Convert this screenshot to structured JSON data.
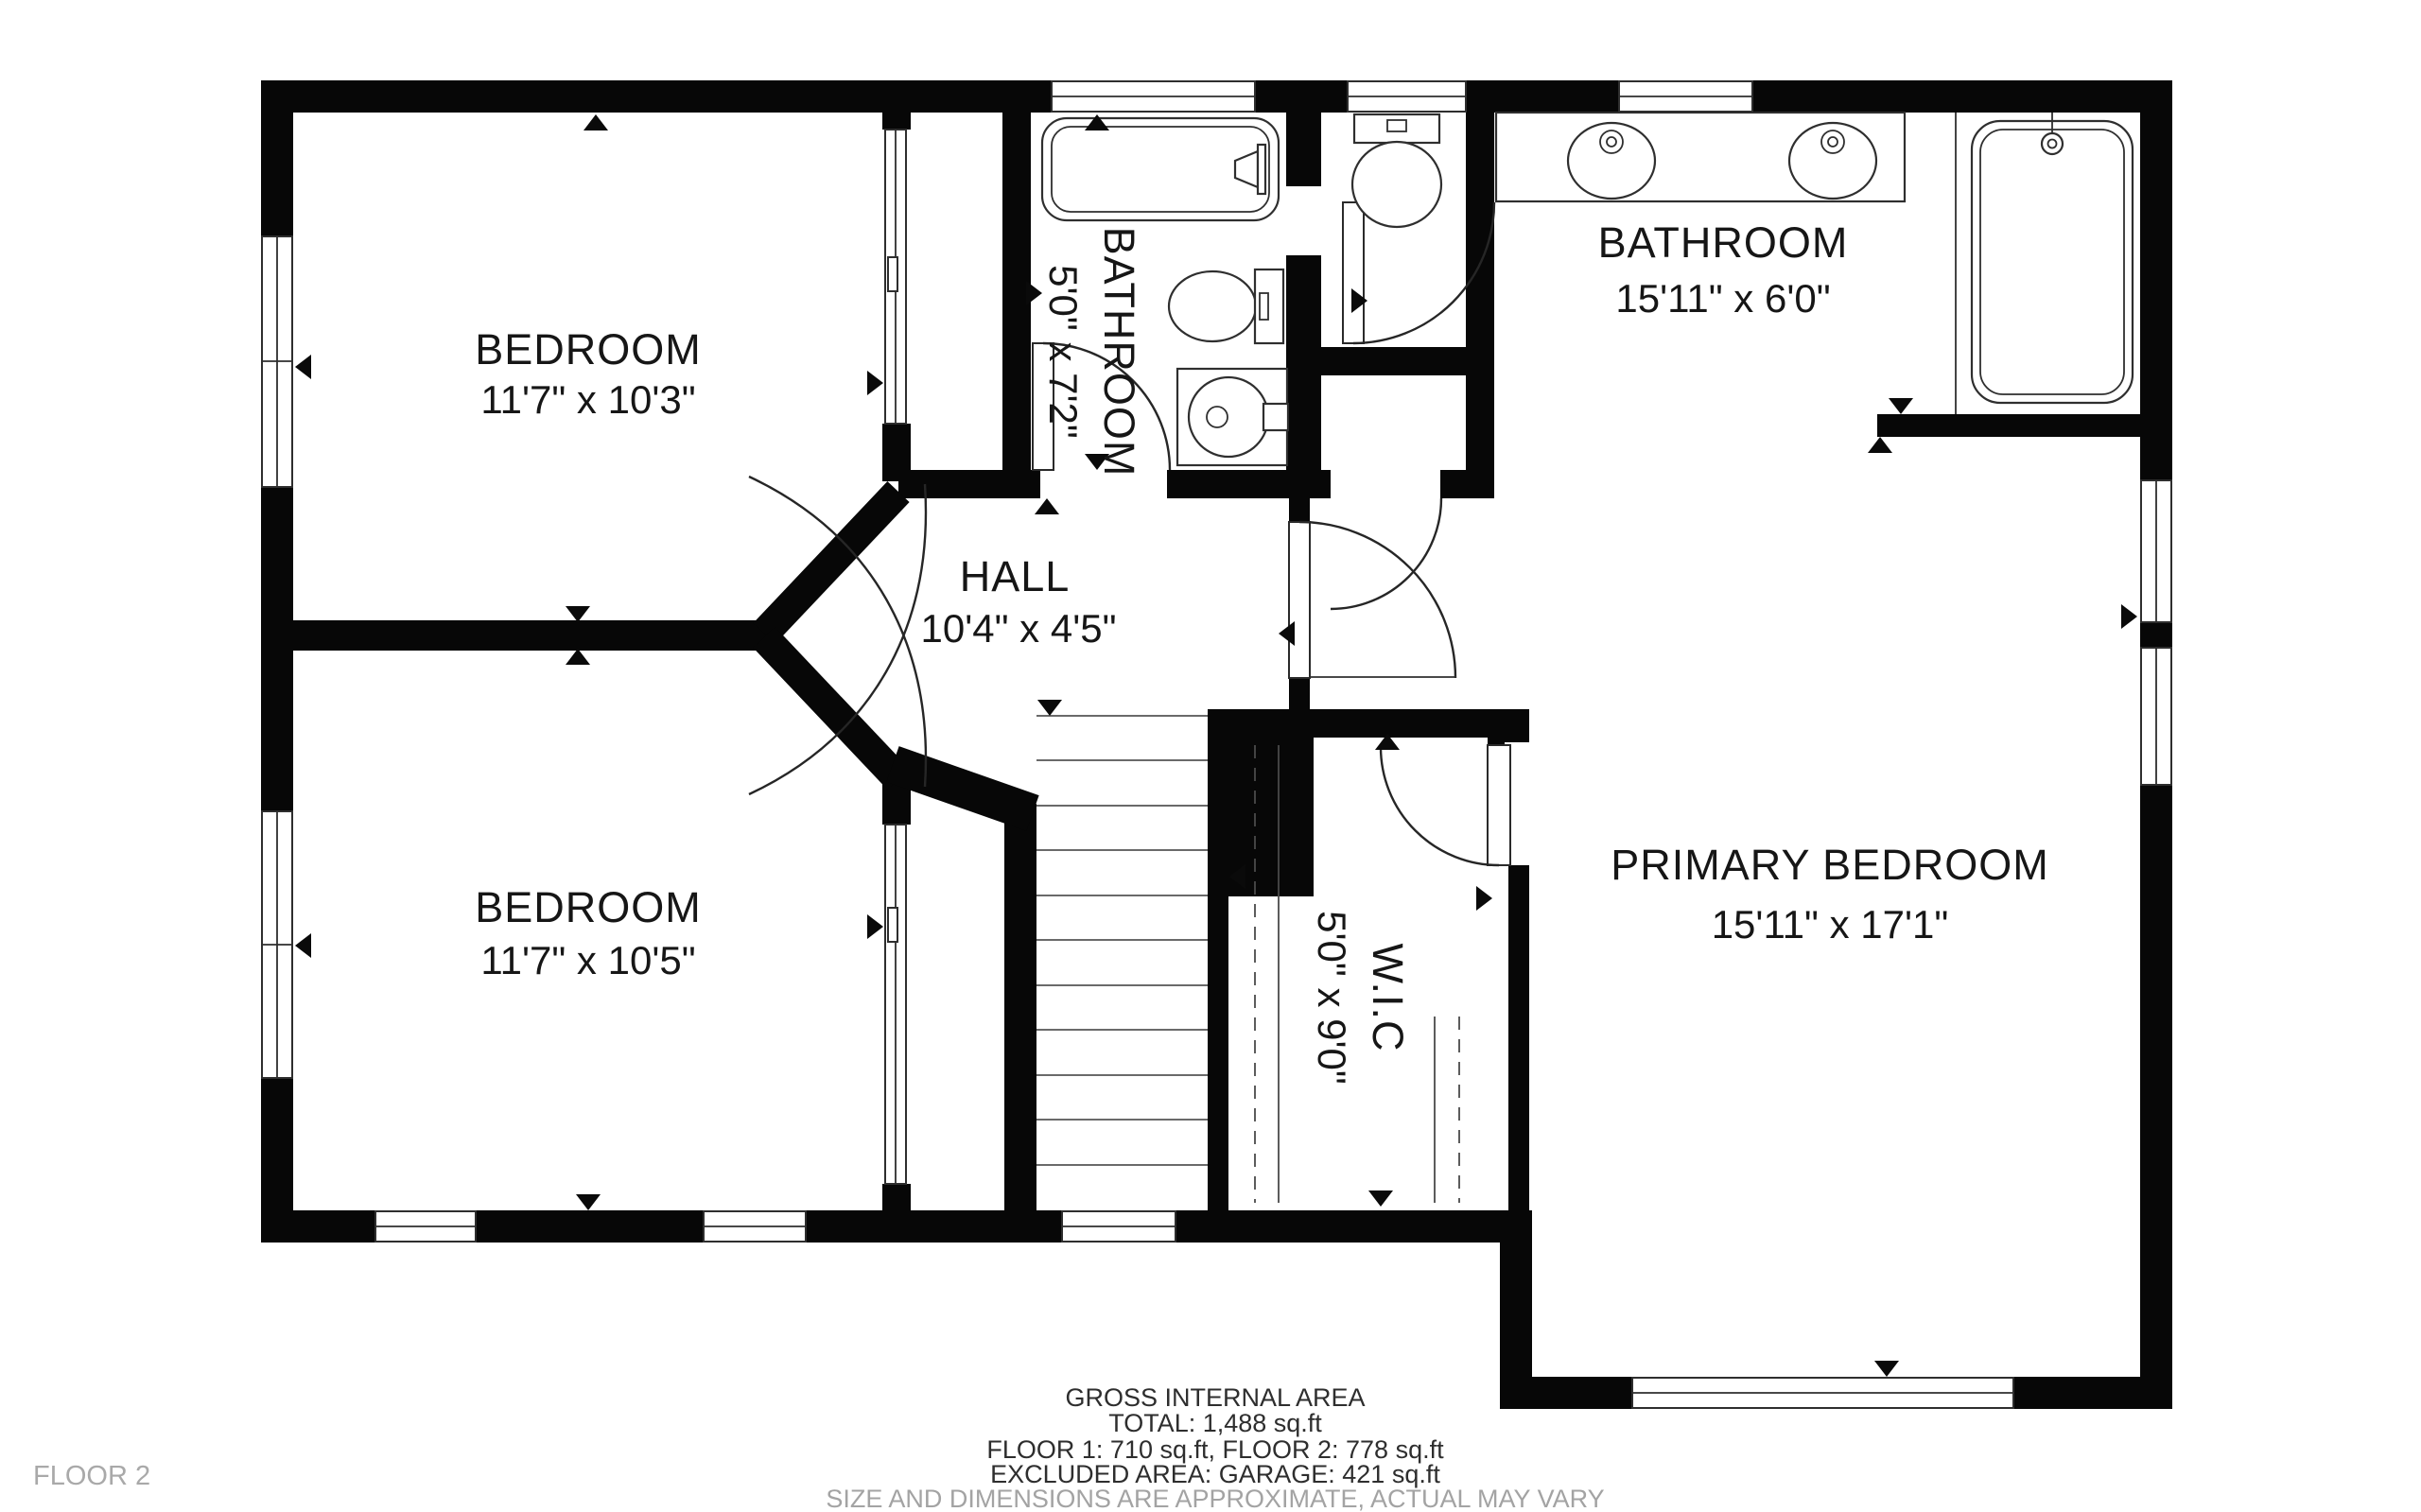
{
  "floor_plan": {
    "floor_label": "FLOOR 2",
    "rooms": [
      {
        "id": "bedroom-top-left",
        "name": "BEDROOM",
        "dims": "11'7\" x 10'3\""
      },
      {
        "id": "bathroom-small",
        "name": "BATHROOM",
        "dims": "5'0\" x 7'2\""
      },
      {
        "id": "bathroom-main",
        "name": "BATHROOM",
        "dims": "15'11\" x 6'0\""
      },
      {
        "id": "hall",
        "name": "HALL",
        "dims": "10'4\" x 4'5\""
      },
      {
        "id": "bedroom-bottom-left",
        "name": "BEDROOM",
        "dims": "11'7\" x 10'5\""
      },
      {
        "id": "walk-in-closet",
        "name": "W.I.C",
        "dims": "5'0\" x 9'0\""
      },
      {
        "id": "primary-bedroom",
        "name": "PRIMARY BEDROOM",
        "dims": "15'11\" x 17'1\""
      }
    ],
    "summary": {
      "title": "GROSS INTERNAL AREA",
      "total": "TOTAL: 1,488 sq.ft",
      "floors": "FLOOR 1: 710 sq.ft, FLOOR 2: 778 sq.ft",
      "excluded": "EXCLUDED AREA: GARAGE: 421 sq.ft",
      "disclaimer": "SIZE AND DIMENSIONS ARE APPROXIMATE, ACTUAL MAY VARY"
    },
    "colors": {
      "wall": "#070707",
      "background": "#ffffff",
      "muted_text": "#a3a3a3"
    }
  }
}
